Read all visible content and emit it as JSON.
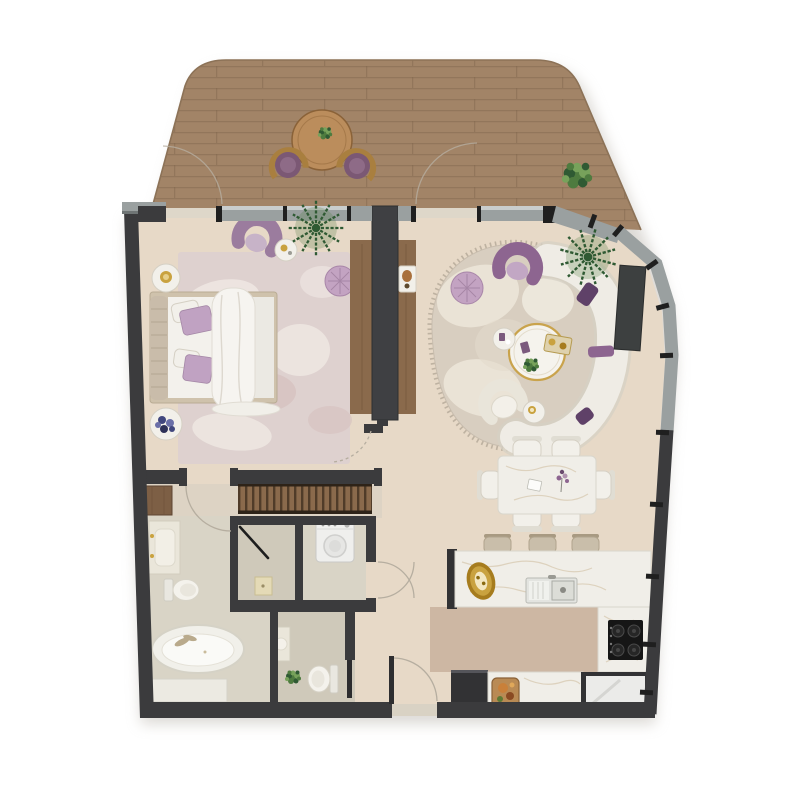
{
  "canvas": {
    "background": "#ffffff"
  },
  "palette": {
    "bg": "#ffffff",
    "shadow": "#b9b4ab",
    "wall_dark": "#3b3b3d",
    "tick_black": "#1f1f1f",
    "window_gray": "#9aa0a0",
    "window_light": "#c9cdcd",
    "deck_wood": "#a28467",
    "deck_plank_line": "#7a6149",
    "deck_edge": "#8c7257",
    "table_wood": "#bb8d5c",
    "floor_main": "#e7d9c7",
    "floor_kitchen": "#cdb7a3",
    "floor_bath": "#d9d4c6",
    "floor_shower": "#cfc9ba",
    "floor_closet": "#ddd3c4",
    "marble": "#f0eee8",
    "marble_stroke": "#d9d6cc",
    "marble_vein": "#d8cab3",
    "furn_white": "#f2f0ea",
    "furn_stroke": "#d5d0c4",
    "bed_linen": "#f3f1ec",
    "bed_frame": "#cfc2ac",
    "headboard": "#c9bcaa",
    "pillow_purple": "#c0a2c2",
    "accent_purple": "#8d6590",
    "deep_purple": "#5f4168",
    "pouf_purple": "#c3a3c2",
    "sofa_white": "#efece5",
    "rug_bedroom": "#ded1cf",
    "rug_living": "#d8cec0",
    "rug_fringe": "#b9ad9c",
    "wood_console": "#8a6a4c",
    "wood_wardrobe": "#7d5f45",
    "gold": "#c9a23f",
    "gold_deep": "#a67c1e",
    "counter_dark": "#323234",
    "cooktop": "#161616",
    "appliance": "#ebebe9",
    "stool": "#c9beaa",
    "arc_line": "#b6aea0",
    "plant_dark": "#2f5a33",
    "plant_mid": "#4e7b3f",
    "plant_light": "#77a25b"
  }
}
